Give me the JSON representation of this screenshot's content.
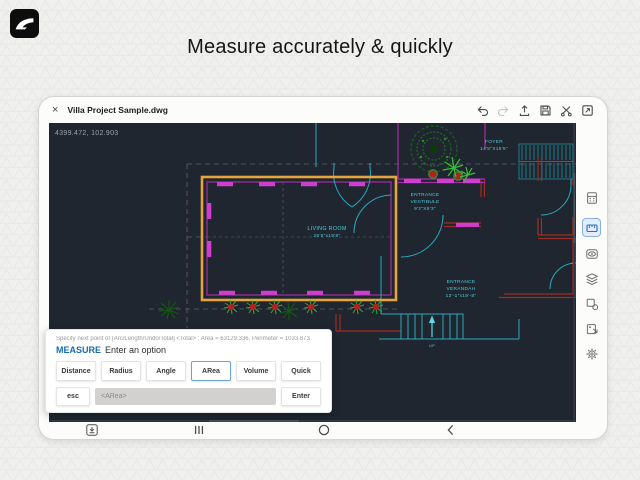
{
  "header": {
    "title": "Measure accurately & quickly"
  },
  "logo": {
    "icon": "autodesk-logo-icon"
  },
  "tablet": {
    "titlebar": {
      "close_label": "×",
      "title": "Villa Project Sample.dwg",
      "icons": [
        "undo-icon",
        "redo-icon",
        "publish-icon",
        "save-icon",
        "snip-icon",
        "fullscreen-icon"
      ]
    },
    "canvas": {
      "coordinates": "4399.472, 102.903",
      "rooms": {
        "living_room": {
          "line1": "LIVING ROOM",
          "line2": "25'5\"x19'9\""
        },
        "vestibule": {
          "line1": "ENTRANCE",
          "line2": "VESTIBULE",
          "line3": "9'2\"X9'3\""
        },
        "foyer": {
          "line1": "FOYER",
          "line2": "14'5\"X15'9\""
        },
        "verandah": {
          "line1": "ENTRANCE",
          "line2": "VERANDAH",
          "line3": "12'-1\"x19'-8\""
        },
        "stairs_label": "UP"
      },
      "colors": {
        "background": "#1f262f",
        "selection_orange": "#e5a43c",
        "walls_magenta": "#a82ca8",
        "walls_red": "#9c2d22",
        "lines_teal": "#2aa9bd",
        "text_cyan": "#4ecddf",
        "plants_green": "#2fae2f"
      }
    },
    "sidebar": {
      "icons": [
        "palette-icon",
        "measure-tool-icon",
        "views-eye-icon",
        "layers-icon",
        "blocks-icon",
        "export-icon",
        "settings-icon"
      ],
      "active_icon": "measure-tool-icon"
    },
    "measure_panel": {
      "prompt": "Specify next point or [Arc/Length/Undo/Total] <Total> ; Area = 63129.336, Perimeter = 1033.873",
      "command": "MEASURE",
      "instruction": "Enter an option",
      "options": [
        "Distance",
        "Radius",
        "Angle",
        "ARea",
        "Volume",
        "Quick"
      ],
      "active_option": "ARea",
      "esc_label": "esc",
      "input_placeholder": "<ARea>",
      "enter_label": "Enter"
    },
    "navbar": {
      "icons": [
        "screen-capture-icon",
        "recents-icon",
        "home-icon",
        "back-icon"
      ]
    }
  }
}
